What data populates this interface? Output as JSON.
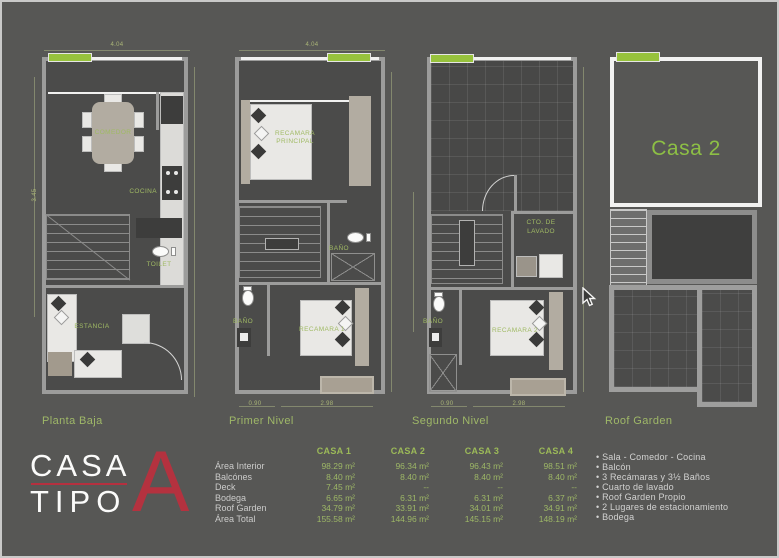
{
  "plans": [
    {
      "label": "Planta Baja",
      "rooms": {
        "comedor": "COMEDOR",
        "cocina": "COCINA",
        "toilet": "TOILET",
        "estancia": "ESTANCIA"
      },
      "dims": {
        "top": "4.04",
        "left": "3.45"
      }
    },
    {
      "label": "Primer Nivel",
      "rooms": {
        "recamara_principal": "RECAMARA\nPRINCIPAL",
        "bano_alto": "BAÑO",
        "bano": "BAÑO",
        "recamara1": "RECAMARA 1"
      },
      "dims": {
        "top": "4.04",
        "bottom_left": "0.90",
        "bottom_right": "2.98"
      }
    },
    {
      "label": "Segundo Nivel",
      "rooms": {
        "cto_lavado": "CTO. DE\nLAVADO",
        "bano": "BAÑO",
        "recamara2": "RECAMARA 2"
      },
      "dims": {
        "bottom_left": "0.90",
        "bottom_right": "2.98"
      }
    },
    {
      "label": "Roof Garden",
      "rooms": {
        "casa2": "Casa 2"
      }
    }
  ],
  "logo": {
    "word1": "CASA",
    "word2": "TIPO",
    "letter": "A"
  },
  "table": {
    "columns": [
      "CASA 1",
      "CASA 2",
      "CASA 3",
      "CASA 4"
    ],
    "rows": [
      {
        "label": "Área Interior",
        "values": [
          "98.29 m²",
          "96.34 m²",
          "96.43 m²",
          "98.51 m²"
        ]
      },
      {
        "label": "Balcónes",
        "values": [
          "8.40 m²",
          "8.40 m²",
          "8.40 m²",
          "8.40 m²"
        ]
      },
      {
        "label": "Deck",
        "values": [
          "7.45 m²",
          "--",
          "--",
          "--"
        ]
      },
      {
        "label": "Bodega",
        "values": [
          "6.65 m²",
          "6.31 m²",
          "6.31 m²",
          "6.37 m²"
        ]
      },
      {
        "label": "Roof Garden",
        "values": [
          "34.79 m²",
          "33.91 m²",
          "34.01 m²",
          "34.91 m²"
        ]
      },
      {
        "label": "Área Total",
        "values": [
          "155.58 m²",
          "144.96 m²",
          "145.15 m²",
          "148.19 m²"
        ]
      }
    ]
  },
  "features": [
    "Sala - Comedor - Cocina",
    "Balcón",
    "3 Recámaras y 3½ Baños",
    "Cuarto de lavado",
    "Roof Garden Propio",
    "2 Lugares de estacionamiento",
    "Bodega"
  ],
  "colors": {
    "background": "#575755",
    "accent_green": "#97c23c",
    "label_green": "#a0ba64",
    "logo_red": "#b5303f",
    "text_gray": "#cbcbca"
  }
}
